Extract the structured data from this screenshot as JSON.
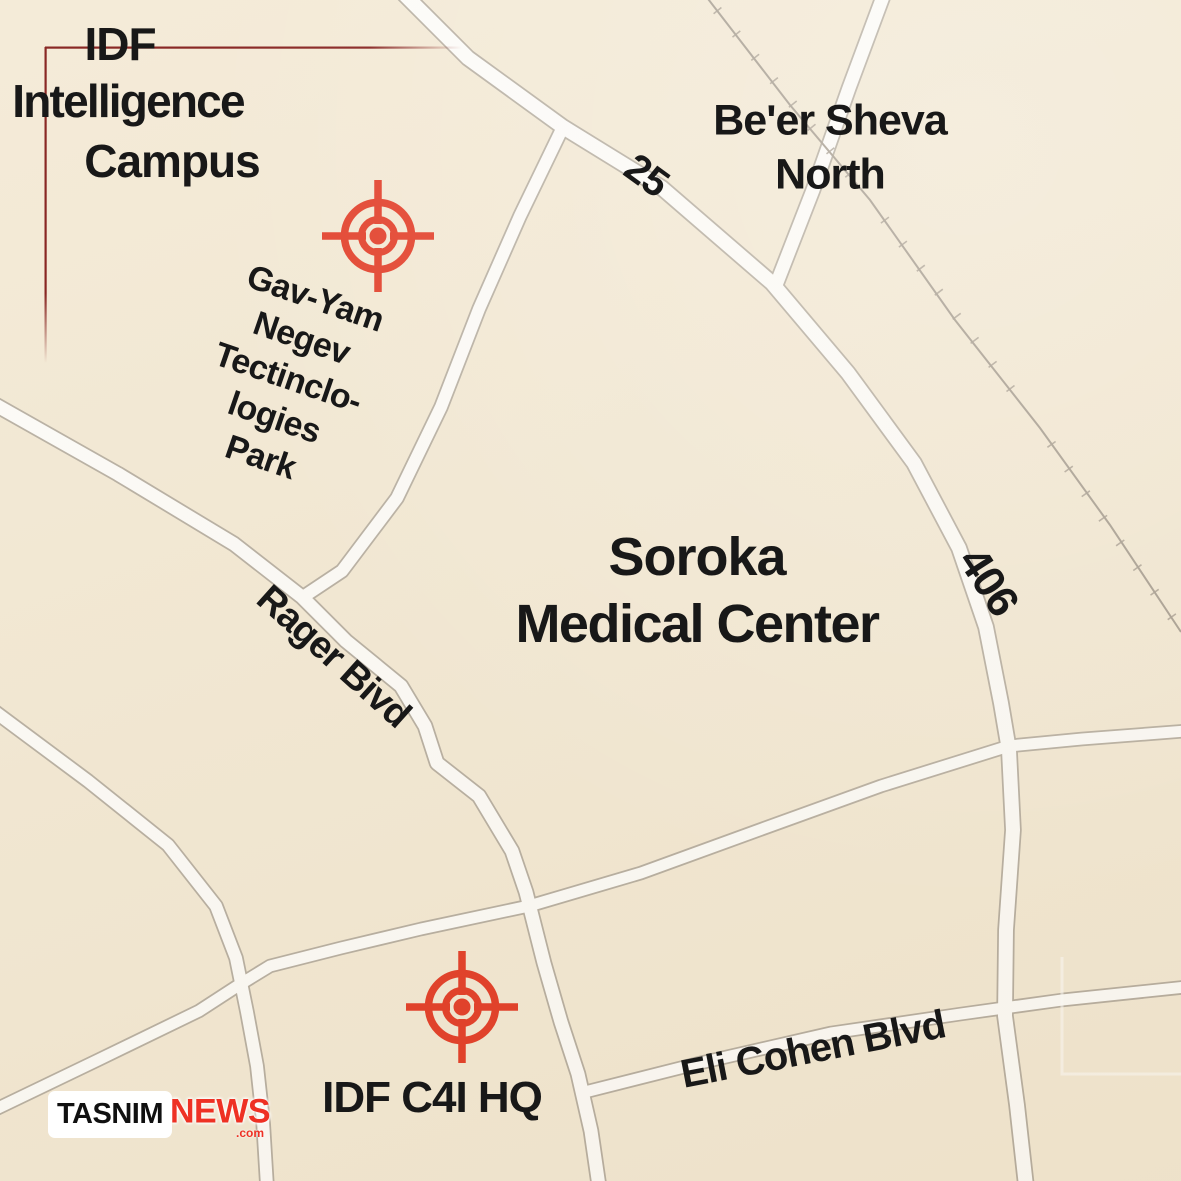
{
  "map": {
    "colors": {
      "background": "#f3e9d4",
      "road_fill": "#fdfcf9",
      "road_border": "#b4ac9f",
      "railway": "#a39a8d",
      "target_red": "#e2351f",
      "callout_line_red": "#7c100d",
      "label_text": "#181818",
      "news_red": "#ee3124"
    },
    "labels": {
      "idf_campus_line1": "IDF",
      "idf_campus_line2": "Intelligence",
      "idf_campus_line3": "Campus",
      "beer_sheva_line1": "Be'er Sheva",
      "beer_sheva_line2": "North",
      "soroka_line1": "Soroka",
      "soroka_line2": "Medical Center",
      "gav_yam_line1": "Gav-Yam",
      "gav_yam_line2": "Negev",
      "gav_yam_line3": "Tectinclo-",
      "gav_yam_line4": "logies",
      "gav_yam_line5": "Park",
      "route_25": "25",
      "route_406": "406",
      "rager_blvd": "Rager Bivd",
      "eli_cohen_blvd": "Eli Cohen Blvd",
      "idf_c4i_hq": "IDF C4I HQ"
    },
    "markers": {
      "gav_yam_target": {
        "x": 378,
        "y": 236
      },
      "c4i_target": {
        "x": 462,
        "y": 1007
      }
    }
  },
  "watermark": {
    "brand": "TASNIM",
    "brand_suffix": "NEWS",
    "domain": ".com"
  }
}
